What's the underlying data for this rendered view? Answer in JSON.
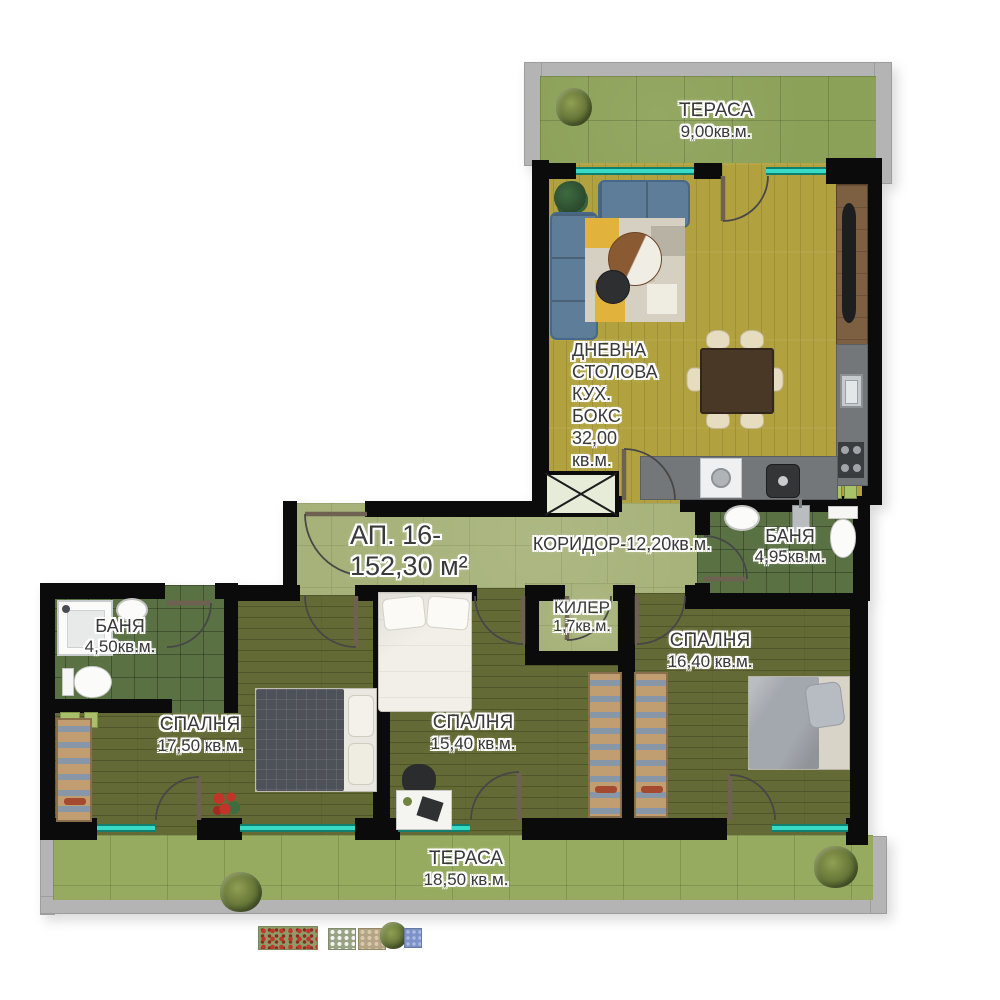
{
  "plan": {
    "apartment_label": {
      "line1": "АП. 16-",
      "line2": "152,30 м²"
    },
    "rooms": {
      "terrace_top": {
        "name": "ТЕРАСА",
        "area": "9,00кв.м."
      },
      "living": {
        "lines": [
          "ДНЕВНА",
          "СТОЛОВА",
          "КУХ.",
          "БОКС",
          "32,00",
          "кв.м."
        ]
      },
      "corridor": {
        "label": "КОРИДОР-12,20кв.м."
      },
      "bath_right": {
        "name": "БАНЯ",
        "area": "4,95кв.м."
      },
      "bath_left": {
        "name": "БАНЯ",
        "area": "4,50кв.м."
      },
      "storage": {
        "name": "КИЛЕР",
        "area": "1,7кв.м."
      },
      "bedroom_right": {
        "name": "СПАЛНЯ",
        "area": "16,40 кв.м."
      },
      "bedroom_left": {
        "name": "СПАЛНЯ",
        "area": "17,50 кв.м."
      },
      "bedroom_middle": {
        "name": "СПАЛНЯ",
        "area": "15,40 кв.м."
      },
      "terrace_bottom": {
        "name": "ТЕРАСА",
        "area": "18,50 кв.м."
      }
    },
    "colors": {
      "wall": "#0b0b0b",
      "window_glass": "#38dcc6",
      "terrace_tile": "#8ca158",
      "living_floor": "#b1a23f",
      "corridor_floor": "#a6b279",
      "bath_tile": "#5a7144",
      "bedroom_floor": "#646a35"
    }
  }
}
